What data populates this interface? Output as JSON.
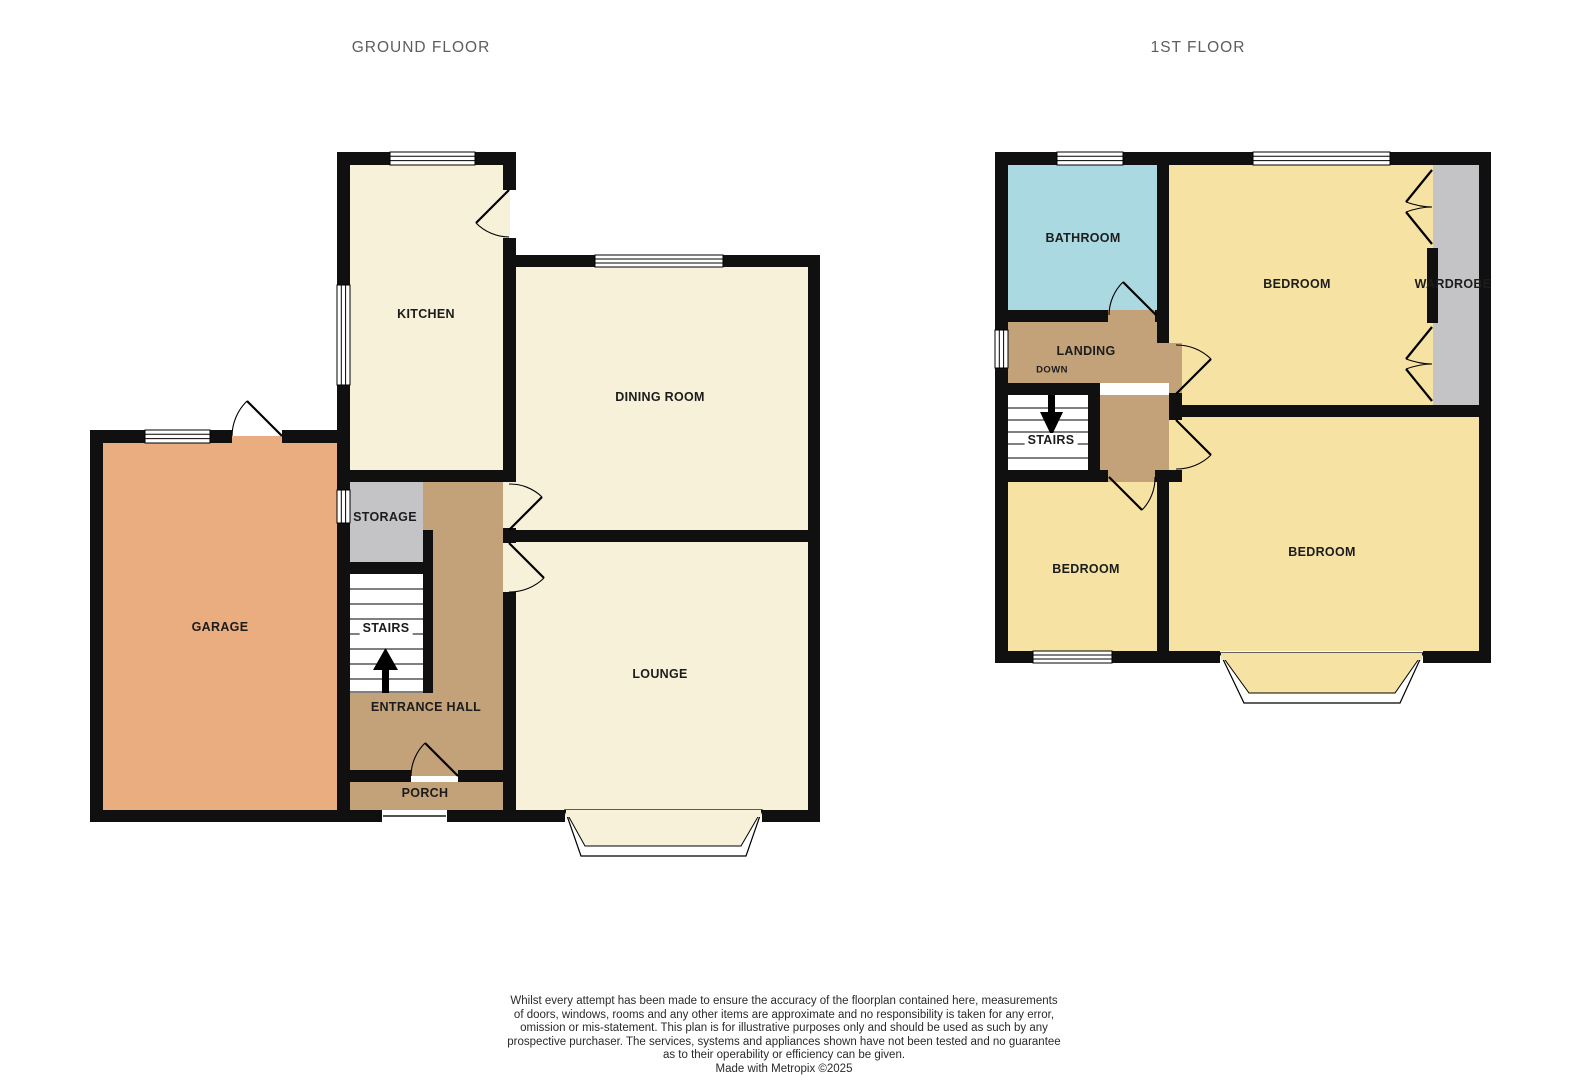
{
  "ground": {
    "title": "GROUND FLOOR",
    "rooms": {
      "kitchen": "KITCHEN",
      "dining_room": "DINING ROOM",
      "garage": "GARAGE",
      "storage": "STORAGE",
      "stairs": "STAIRS",
      "entrance_hall": "ENTRANCE HALL",
      "porch": "PORCH",
      "lounge": "LOUNGE"
    }
  },
  "first": {
    "title": "1ST FLOOR",
    "rooms": {
      "bathroom": "BATHROOM",
      "bedroom_front": "BEDROOM",
      "wardrobe": "WARDROBE",
      "landing": "LANDING",
      "down_label": "DOWN",
      "stairs": "STAIRS",
      "bedroom_side": "BEDROOM",
      "bedroom_rear": "BEDROOM"
    }
  },
  "colors": {
    "wall": "#101010",
    "cream": "#f7f1da",
    "garage": "#e9ad80",
    "tan": "#c3a27a",
    "yellow": "#f6e3a3",
    "blue": "#abd9e2",
    "gray": "#c4c4c6",
    "title_gray": "#5d5d60",
    "label": "#1c1c1c"
  },
  "notes": {
    "lines": [
      "Whilst every attempt has been made to ensure the accuracy of the floorplan contained here, measurements",
      "of doors, windows, rooms and any other items are approximate and no responsibility is taken for any error,",
      "omission or mis-statement. This plan is for illustrative purposes only and should be used as such by any",
      "prospective purchaser. The services, systems and appliances shown have not been tested and no guarantee",
      "as to their operability or efficiency can be given."
    ],
    "credit": "Made with Metropix ©2025"
  }
}
